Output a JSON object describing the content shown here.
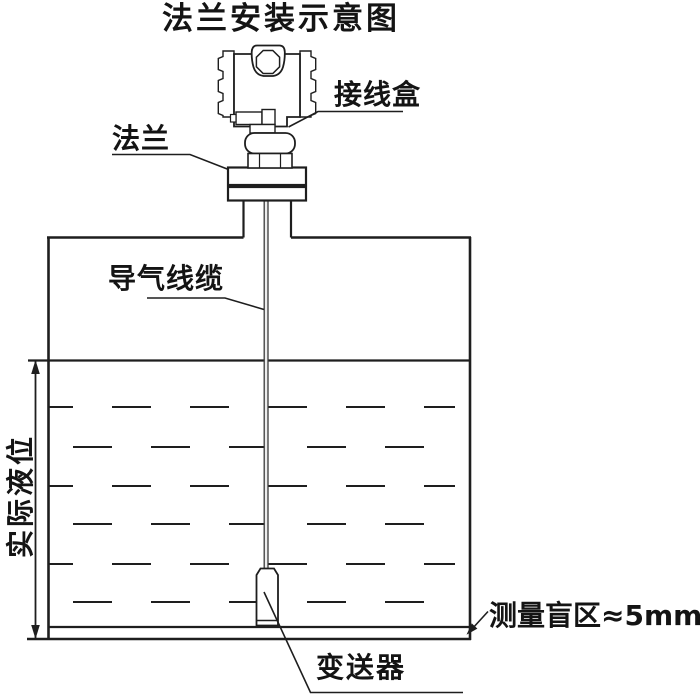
{
  "title": "法兰安装示意图",
  "labels": {
    "junction_box": "接线盒",
    "flange": "法兰",
    "air_cable": "导气线缆",
    "actual_level": "实际液位",
    "blind_zone": "测量盲区≈5mm",
    "transmitter": "变送器"
  },
  "colors": {
    "line": "#1e1e1e",
    "cable_line": "#3a3a3a",
    "cable_fill": "#ededed",
    "background": "#ffffff"
  }
}
